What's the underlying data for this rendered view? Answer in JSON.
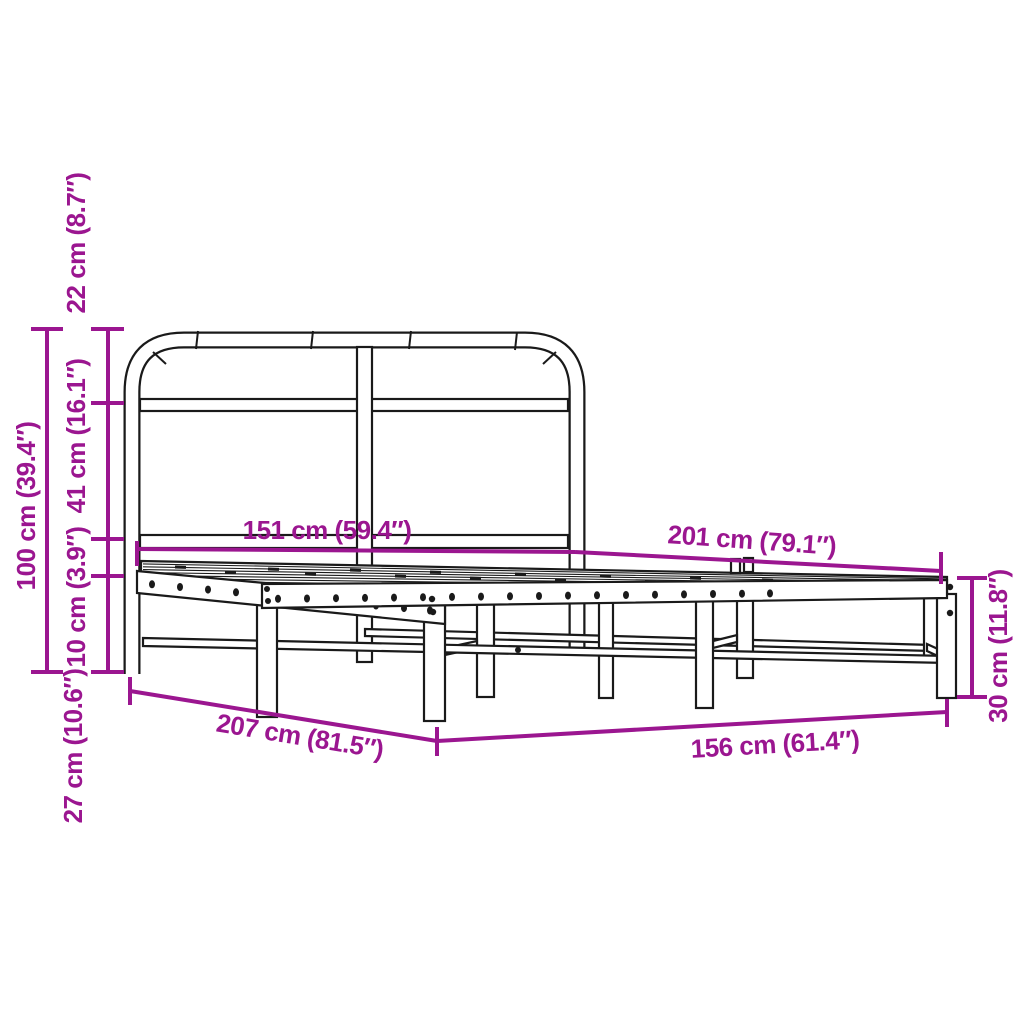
{
  "figure": {
    "kind": "product-dimension-diagram"
  },
  "colors": {
    "accent": "#9B1690",
    "line": "#1A1A1A",
    "background": "#FFFFFF"
  },
  "dimensions": {
    "headboard_top_section_height": {
      "label": "22 cm (8.7″)"
    },
    "headboard_mid_section_height": {
      "label": "41 cm (16.1″)"
    },
    "rail_to_base_height": {
      "label": "10 cm (3.9″)"
    },
    "base_to_floor_height": {
      "label": "27 cm (10.6″)"
    },
    "headboard_total_height": {
      "label": "100 cm (39.4″)"
    },
    "headboard_width": {
      "label": "151 cm (59.4″)"
    },
    "frame_inner_length": {
      "label": "201 cm (79.1″)"
    },
    "frame_outer_length": {
      "label": "207 cm (81.5″)"
    },
    "frame_outer_width": {
      "label": "156 cm (61.4″)"
    },
    "frame_side_height": {
      "label": "30 cm (11.8″)"
    }
  }
}
